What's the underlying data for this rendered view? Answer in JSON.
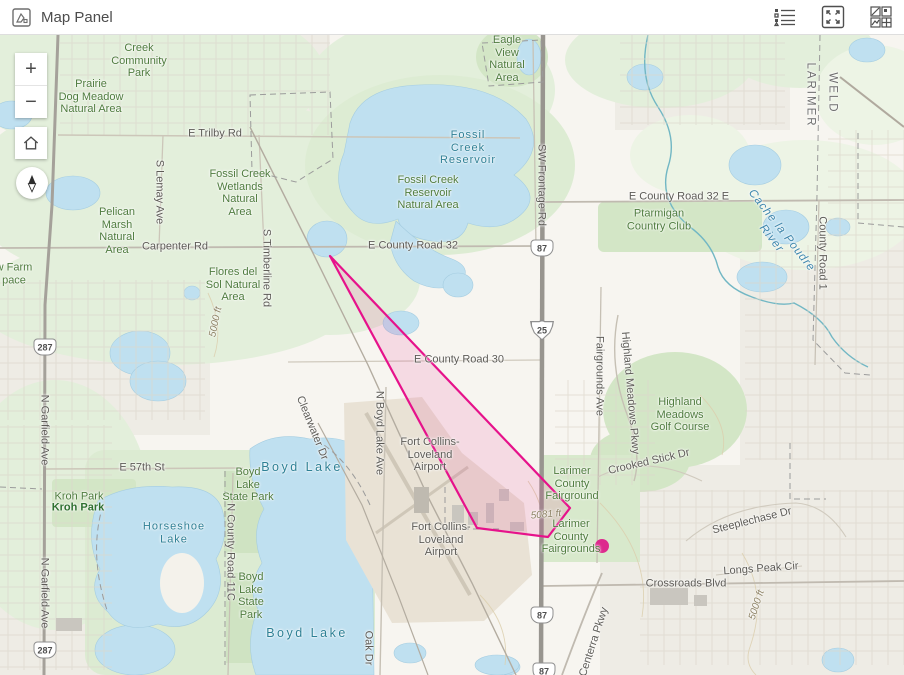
{
  "header": {
    "title": "Map Panel",
    "icons": [
      "map-panel-icon",
      "legend-list-icon",
      "expand-icon",
      "basemap-gallery-icon"
    ]
  },
  "controls": {
    "zoom_in": "+",
    "zoom_out": "−"
  },
  "map": {
    "labels": [
      {
        "t": "Creek\nCommunity\nPark",
        "x": 139,
        "y": 26,
        "c": "park"
      },
      {
        "t": "Prairie\nDog Meadow\nNatural Area",
        "x": 91,
        "y": 62,
        "c": "park"
      },
      {
        "t": "E Trilby Rd",
        "x": 215,
        "y": 99,
        "c": "road"
      },
      {
        "t": "Eagle\nView\nNatural\nArea",
        "x": 507,
        "y": 24,
        "c": "park"
      },
      {
        "t": "Fossil\nCreek\nReservoir",
        "x": 468,
        "y": 113,
        "c": "water"
      },
      {
        "t": "Fossil Creek\nWetlands\nNatural\nArea",
        "x": 240,
        "y": 158,
        "c": "park"
      },
      {
        "t": "Fossil Creek\nReservoir\nNatural Area",
        "x": 428,
        "y": 158,
        "c": "park"
      },
      {
        "t": "S Lemay Ave",
        "x": 159,
        "y": 157,
        "c": "road",
        "r": 90
      },
      {
        "t": "SW Frontage Rd",
        "x": 541,
        "y": 150,
        "c": "road",
        "r": 90
      },
      {
        "t": "LARIMER",
        "x": 810,
        "y": 60,
        "c": "county",
        "r": 90
      },
      {
        "t": "WELD",
        "x": 832,
        "y": 58,
        "c": "county",
        "r": 90
      },
      {
        "t": "E County Road 32 E",
        "x": 679,
        "y": 162,
        "c": "road"
      },
      {
        "t": "Ptarmigan\nCountry Club",
        "x": 659,
        "y": 185,
        "c": "park"
      },
      {
        "t": "Cache la Poudre River",
        "x": 776,
        "y": 200,
        "c": "river",
        "r": 52
      },
      {
        "t": "County Road 1",
        "x": 822,
        "y": 218,
        "c": "road",
        "r": 90
      },
      {
        "t": "Pelican\nMarsh\nNatural\nArea",
        "x": 117,
        "y": 196,
        "c": "park"
      },
      {
        "t": "Carpenter Rd",
        "x": 175,
        "y": 212,
        "c": "road"
      },
      {
        "t": "w Farm\npace",
        "x": 14,
        "y": 239,
        "c": "park"
      },
      {
        "t": "Flores del\nSol Natural\nArea",
        "x": 233,
        "y": 250,
        "c": "park"
      },
      {
        "t": "S Timberline Rd",
        "x": 266,
        "y": 233,
        "c": "road",
        "r": 90
      },
      {
        "t": "5000 ft",
        "x": 216,
        "y": 287,
        "c": "contour",
        "r": -78
      },
      {
        "t": "E County Road 32",
        "x": 413,
        "y": 211,
        "c": "road"
      },
      {
        "t": "E County Road 30",
        "x": 459,
        "y": 325,
        "c": "road"
      },
      {
        "t": "N Boyd Lake Ave",
        "x": 379,
        "y": 398,
        "c": "road",
        "r": 90
      },
      {
        "t": "Fort Collins-\nLoveland\nAirport",
        "x": 430,
        "y": 420,
        "c": "road"
      },
      {
        "t": "Fort Collins-\nLoveland\nAirport",
        "x": 441,
        "y": 505,
        "c": "road"
      },
      {
        "t": "Larimer\nCounty\nFairground",
        "x": 572,
        "y": 449,
        "c": "park"
      },
      {
        "t": "Larimer\nCounty\nFairgrounds",
        "x": 571,
        "y": 502,
        "c": "park"
      },
      {
        "t": "5081 ft",
        "x": 546,
        "y": 480,
        "c": "contour",
        "r": -5
      },
      {
        "t": "Highland Meadows Pkwy",
        "x": 630,
        "y": 358,
        "c": "road",
        "r": 85
      },
      {
        "t": "Highland\nMeadows\nGolf Course",
        "x": 680,
        "y": 380,
        "c": "park"
      },
      {
        "t": "Crooked Stick Dr",
        "x": 649,
        "y": 427,
        "c": "road",
        "r": -13
      },
      {
        "t": "Steeplechase Dr",
        "x": 752,
        "y": 486,
        "c": "road",
        "r": -14
      },
      {
        "t": "Longs Peak Cir",
        "x": 761,
        "y": 534,
        "c": "road",
        "r": -4
      },
      {
        "t": "Crossroads Blvd",
        "x": 686,
        "y": 549,
        "c": "road"
      },
      {
        "t": "5000 ft",
        "x": 757,
        "y": 570,
        "c": "contour",
        "r": -72
      },
      {
        "t": "E 57th St",
        "x": 142,
        "y": 433,
        "c": "road"
      },
      {
        "t": "Kroh Park",
        "x": 79,
        "y": 462,
        "c": "park"
      },
      {
        "t": "Kroh Park",
        "x": 78,
        "y": 473,
        "c": "parkdark"
      },
      {
        "t": "Horseshoe\nLake",
        "x": 174,
        "y": 498,
        "c": "water"
      },
      {
        "t": "N Garfield Ave",
        "x": 44,
        "y": 395,
        "c": "road",
        "r": 90
      },
      {
        "t": "N Garfield Ave",
        "x": 44,
        "y": 558,
        "c": "road",
        "r": 90
      },
      {
        "t": "N County Road 11C",
        "x": 230,
        "y": 517,
        "c": "road",
        "r": 90
      },
      {
        "t": "Boyd\nLake\nState Park",
        "x": 248,
        "y": 450,
        "c": "park"
      },
      {
        "t": "Boyd\nLake\nState\nPark",
        "x": 251,
        "y": 561,
        "c": "park"
      },
      {
        "t": "Boyd Lake",
        "x": 302,
        "y": 432,
        "c": "waterbig"
      },
      {
        "t": "Boyd Lake",
        "x": 307,
        "y": 598,
        "c": "waterbig"
      },
      {
        "t": "Clearwater Dr",
        "x": 312,
        "y": 393,
        "c": "road",
        "r": 68
      },
      {
        "t": "Oak Dr",
        "x": 368,
        "y": 613,
        "c": "road",
        "r": 90
      },
      {
        "t": "Fairgrounds Ave",
        "x": 599,
        "y": 341,
        "c": "road",
        "r": 90
      },
      {
        "t": "Centerra Pkwy",
        "x": 594,
        "y": 607,
        "c": "road",
        "r": -72
      }
    ],
    "shields": [
      {
        "n": "287",
        "x": 45,
        "y": 312,
        "k": "us"
      },
      {
        "n": "287",
        "x": 45,
        "y": 615,
        "k": "us"
      },
      {
        "n": "87",
        "x": 542,
        "y": 213,
        "k": "us"
      },
      {
        "n": "25",
        "x": 542,
        "y": 295,
        "k": "i"
      },
      {
        "n": "87",
        "x": 542,
        "y": 580,
        "k": "us"
      },
      {
        "n": "87",
        "x": 544,
        "y": 636,
        "k": "us"
      }
    ],
    "overlay": {
      "polygon": {
        "points": "330,221 570,473 548,502 477,493",
        "stroke": "#e6128b",
        "fill": "rgba(232,40,140,0.13)"
      },
      "marker": {
        "x": 602,
        "y": 511,
        "r": 7,
        "color": "#dd2a8d"
      }
    }
  }
}
